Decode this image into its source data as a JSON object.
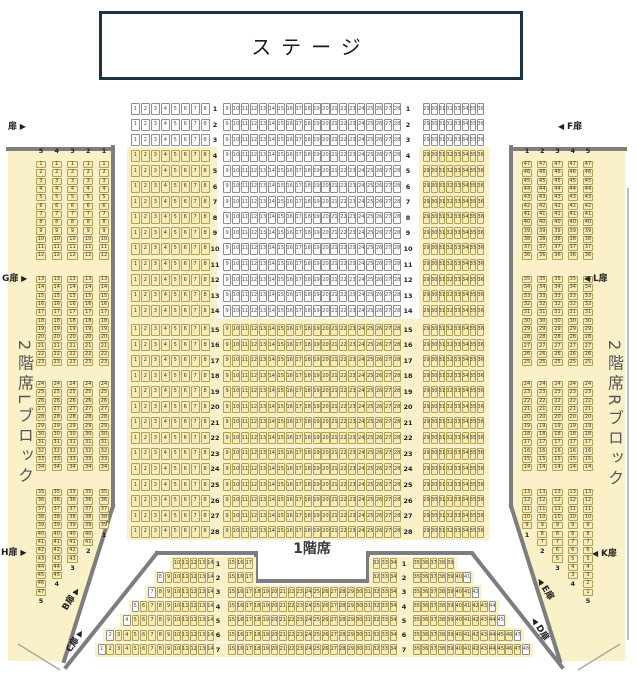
{
  "colors": {
    "seat_yellow_bg": "#f8ecb4",
    "seat_yellow_border": "#b1a058",
    "seat_white_bg": "#fcfcfc",
    "seat_white_border": "#8f8f8f",
    "panel_bg": "#faf1c8",
    "wall": "#7d7d7d",
    "stage_border": "#1b3642"
  },
  "stage": {
    "label": "ステージ"
  },
  "labels": {
    "floor1": "1階席",
    "balcony_left": "2階席Lブロック",
    "balcony_right": "2階席Rブロック"
  },
  "floor1": {
    "row_count": 28,
    "blocks": {
      "left": {
        "from": 1,
        "to": 8
      },
      "center": {
        "from": 9,
        "to": 28
      },
      "right": {
        "from": 29,
        "to": 36
      }
    },
    "white_all_rows_to": 3,
    "center_white_rows_to": 14,
    "aisle_after_row": 14
  },
  "rear": {
    "left_block_to": 14,
    "center_from": 15,
    "center_to": 34,
    "right_block_from": 35,
    "gap_center_left_to": 17,
    "gap_center_right_from": 32,
    "rows": [
      {
        "n": 1,
        "left_from": 10,
        "right_to": 39,
        "center_gap": true
      },
      {
        "n": 2,
        "left_from": 8,
        "right_to": 41,
        "center_gap": true
      },
      {
        "n": 3,
        "left_from": 7,
        "right_to": 42
      },
      {
        "n": 4,
        "left_from": 5,
        "right_to": 44
      },
      {
        "n": 5,
        "left_from": 4,
        "right_to": 45
      },
      {
        "n": 6,
        "left_from": 2,
        "right_to": 47
      },
      {
        "n": 7,
        "left_from": 1,
        "right_to": 48
      }
    ]
  },
  "balcony_left": {
    "header": [
      5,
      4,
      3,
      2,
      1
    ],
    "order": "ascending",
    "groups": [
      [
        1,
        12
      ],
      [
        13,
        23
      ],
      [
        24,
        34
      ]
    ],
    "last_group_from": 35,
    "column_last": {
      "1": 39,
      "2": 41,
      "3": 43,
      "4": 45,
      "5": 47
    }
  },
  "balcony_right": {
    "header": [
      1,
      2,
      3,
      4,
      5
    ],
    "order": "descending",
    "groups": [
      [
        47,
        36
      ],
      [
        35,
        25
      ],
      [
        24,
        14
      ]
    ],
    "last_group_from": 13,
    "column_last": {
      "1": 9,
      "2": 7,
      "3": 5,
      "4": 3,
      "5": 1
    }
  },
  "doors": [
    {
      "id": "top-left",
      "label": "扉",
      "arrow": "right",
      "x": 8,
      "y": 119,
      "rotate": 0
    },
    {
      "id": "f",
      "label": "F扉",
      "arrow": "left",
      "x": 558,
      "y": 119,
      "rotate": 0
    },
    {
      "id": "g",
      "label": "G扉",
      "arrow": "right",
      "x": 2,
      "y": 271,
      "rotate": 0
    },
    {
      "id": "l",
      "label": "L扉",
      "arrow": "left",
      "x": 584,
      "y": 271,
      "rotate": 0
    },
    {
      "id": "h",
      "label": "H扉",
      "arrow": "right",
      "x": 1,
      "y": 545,
      "rotate": 0
    },
    {
      "id": "k",
      "label": "K扉",
      "arrow": "left",
      "x": 592,
      "y": 546,
      "rotate": 0
    },
    {
      "id": "b",
      "label": "B扉",
      "arrow": "right",
      "x": 58,
      "y": 592,
      "rotate": -58
    },
    {
      "id": "c",
      "label": "C扉",
      "arrow": "right",
      "x": 62,
      "y": 634,
      "rotate": -58
    },
    {
      "id": "e",
      "label": "E扉",
      "arrow": "left",
      "x": 534,
      "y": 582,
      "rotate": 58
    },
    {
      "id": "d",
      "label": "D扉",
      "arrow": "left",
      "x": 528,
      "y": 622,
      "rotate": 58
    }
  ]
}
